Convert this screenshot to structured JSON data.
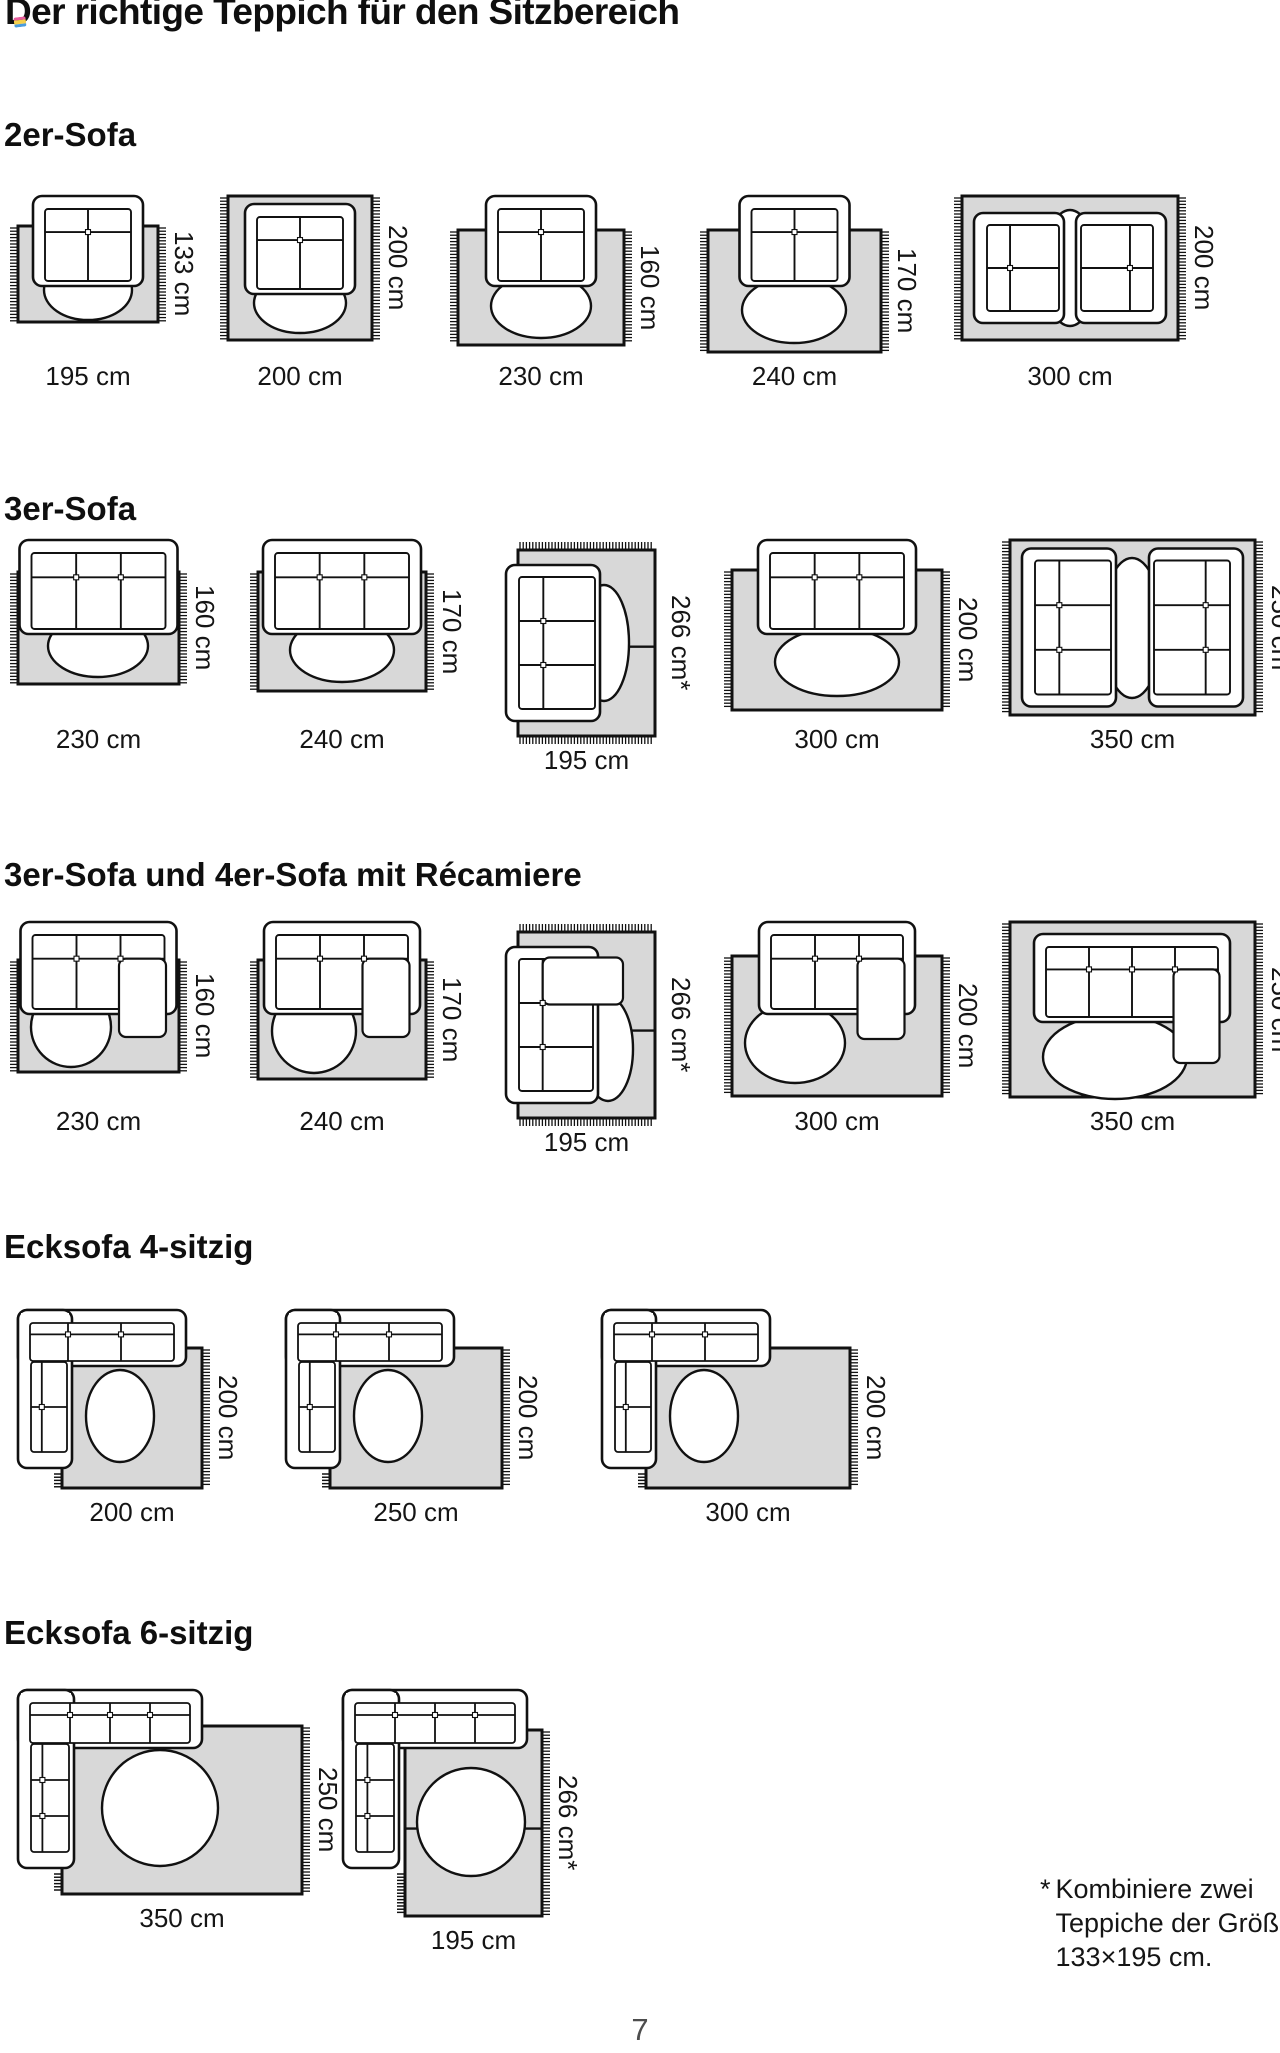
{
  "page": {
    "title": "Der richtige Teppich für den Sitzbereich",
    "page_number": "7",
    "footnote": {
      "marker": "*",
      "text": "Kombiniere zwei\nTeppiche der Größe\n133×195 cm."
    },
    "colors": {
      "rug_fill": "#d8d8d8",
      "line": "#111111",
      "text": "#151515",
      "page_number": "#4d4d4d",
      "badge_stripes": [
        "#e85d9e",
        "#f5d04c",
        "#4a9bdc"
      ]
    }
  },
  "sections": [
    {
      "heading": "2er-Sofa",
      "diagrams": [
        {
          "kind": "overhang",
          "seats": 2,
          "rug_w_cm": 195,
          "rug_h_cm": 133,
          "bottom_label": "195 cm",
          "side_label": "133 cm",
          "combined_rugs": false
        },
        {
          "kind": "inside",
          "seats": 2,
          "rug_w_cm": 200,
          "rug_h_cm": 200,
          "bottom_label": "200 cm",
          "side_label": "200 cm",
          "combined_rugs": false
        },
        {
          "kind": "overhang",
          "seats": 2,
          "rug_w_cm": 230,
          "rug_h_cm": 160,
          "bottom_label": "230 cm",
          "side_label": "160 cm",
          "combined_rugs": false
        },
        {
          "kind": "overhang",
          "seats": 2,
          "rug_w_cm": 240,
          "rug_h_cm": 170,
          "bottom_label": "240 cm",
          "side_label": "170 cm",
          "combined_rugs": false
        },
        {
          "kind": "facing",
          "seats": 2,
          "rug_w_cm": 300,
          "rug_h_cm": 200,
          "bottom_label": "300 cm",
          "side_label": "200 cm",
          "combined_rugs": false
        }
      ]
    },
    {
      "heading": "3er-Sofa",
      "diagrams": [
        {
          "kind": "overhang",
          "seats": 3,
          "rug_w_cm": 230,
          "rug_h_cm": 160,
          "bottom_label": "230 cm",
          "side_label": "160 cm",
          "combined_rugs": false
        },
        {
          "kind": "overhang",
          "seats": 3,
          "rug_w_cm": 240,
          "rug_h_cm": 170,
          "bottom_label": "240 cm",
          "side_label": "170 cm",
          "combined_rugs": false
        },
        {
          "kind": "vert",
          "seats": 3,
          "rug_w_cm": 195,
          "rug_h_cm": 266,
          "bottom_label": "195 cm",
          "side_label": "266 cm*",
          "combined_rugs": true
        },
        {
          "kind": "overhang",
          "seats": 3,
          "rug_w_cm": 300,
          "rug_h_cm": 200,
          "bottom_label": "300 cm",
          "side_label": "200 cm",
          "combined_rugs": false
        },
        {
          "kind": "facing",
          "seats": 3,
          "rug_w_cm": 350,
          "rug_h_cm": 250,
          "bottom_label": "350 cm",
          "side_label": "250 cm",
          "combined_rugs": false
        }
      ]
    },
    {
      "heading": "3er-Sofa und 4er-Sofa mit Récamiere",
      "diagrams": [
        {
          "kind": "chaise",
          "seats": 3,
          "rug_w_cm": 230,
          "rug_h_cm": 160,
          "bottom_label": "230 cm",
          "side_label": "160 cm",
          "combined_rugs": false
        },
        {
          "kind": "chaise",
          "seats": 3,
          "rug_w_cm": 240,
          "rug_h_cm": 170,
          "bottom_label": "240 cm",
          "side_label": "170 cm",
          "combined_rugs": false
        },
        {
          "kind": "vert-chaise",
          "seats": 3,
          "rug_w_cm": 195,
          "rug_h_cm": 266,
          "bottom_label": "195 cm",
          "side_label": "266 cm*",
          "combined_rugs": true
        },
        {
          "kind": "chaise",
          "seats": 3,
          "rug_w_cm": 300,
          "rug_h_cm": 200,
          "bottom_label": "300 cm",
          "side_label": "200 cm",
          "combined_rugs": false
        },
        {
          "kind": "chaise-inside",
          "seats": 4,
          "rug_w_cm": 350,
          "rug_h_cm": 250,
          "bottom_label": "350 cm",
          "side_label": "250 cm",
          "combined_rugs": false
        }
      ]
    },
    {
      "heading": "Ecksofa 4-sitzig",
      "diagrams": [
        {
          "kind": "corner",
          "top_seats": 3,
          "left_seats": 2,
          "rug_w_cm": 200,
          "rug_h_cm": 200,
          "bottom_label": "200 cm",
          "side_label": "200 cm",
          "combined_rugs": false
        },
        {
          "kind": "corner",
          "top_seats": 3,
          "left_seats": 2,
          "rug_w_cm": 250,
          "rug_h_cm": 200,
          "bottom_label": "250 cm",
          "side_label": "200 cm",
          "combined_rugs": false
        },
        {
          "kind": "corner",
          "top_seats": 3,
          "left_seats": 2,
          "rug_w_cm": 300,
          "rug_h_cm": 200,
          "bottom_label": "300 cm",
          "side_label": "200 cm",
          "combined_rugs": false
        }
      ]
    },
    {
      "heading": "Ecksofa 6-sitzig",
      "diagrams": [
        {
          "kind": "corner",
          "top_seats": 4,
          "left_seats": 3,
          "rug_w_cm": 350,
          "rug_h_cm": 250,
          "bottom_label": "350 cm",
          "side_label": "250 cm",
          "combined_rugs": false
        },
        {
          "kind": "corner-vert",
          "top_seats": 4,
          "left_seats": 3,
          "rug_w_cm": 195,
          "rug_h_cm": 266,
          "bottom_label": "195 cm",
          "side_label": "266 cm*",
          "combined_rugs": true
        }
      ]
    }
  ]
}
